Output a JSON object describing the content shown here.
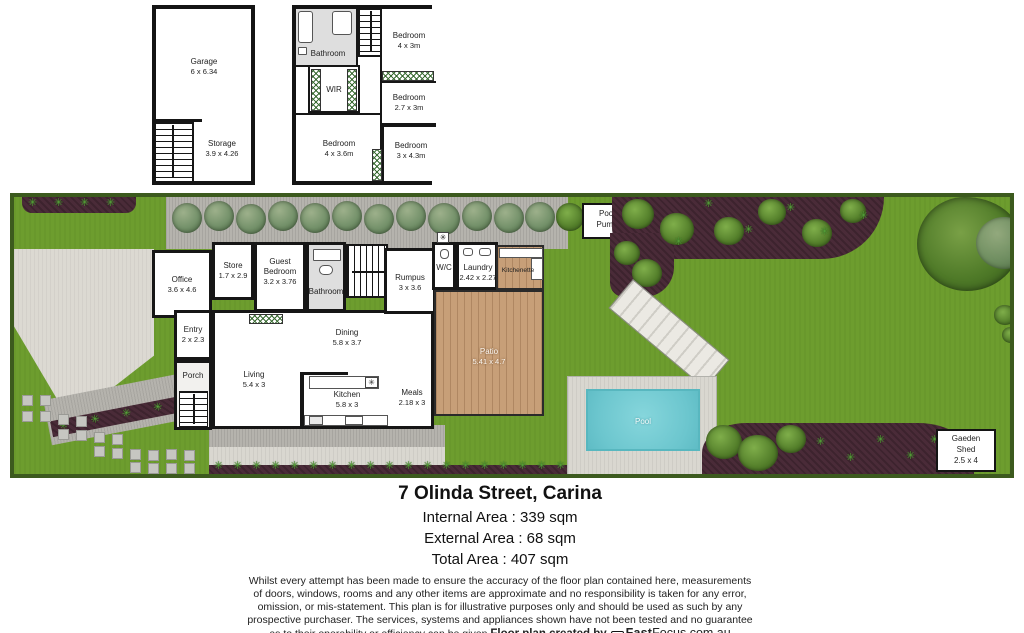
{
  "icons": {
    "plant": "✳",
    "fan": "✳",
    "logo_glyph": "ϟ"
  },
  "garage_plan": {
    "garage": {
      "name": "Garage",
      "dims": "6 x 6.34"
    },
    "storage": {
      "name": "Storage",
      "dims": "3.9 x 4.26"
    }
  },
  "upper_plan": {
    "bathroom": {
      "name": "Bathroom"
    },
    "bed1": {
      "name": "Bedroom",
      "dims": "4 x 3m"
    },
    "wir": {
      "name": "WIR"
    },
    "bed2": {
      "name": "Bedroom",
      "dims": "2.7 x 3m"
    },
    "bed3": {
      "name": "Bedroom",
      "dims": "4 x 3.6m"
    },
    "bed4": {
      "name": "Bedroom",
      "dims": "3 x 4.3m"
    }
  },
  "ground_floor": {
    "office": {
      "name": "Office",
      "dims": "3.6 x 4.6"
    },
    "store": {
      "name": "Store",
      "dims": "1.7 x 2.9"
    },
    "guest_bedroom": {
      "name": "Guest Bedroom",
      "dims": "3.2 x 3.76"
    },
    "bathroom": {
      "name": "Bathroom"
    },
    "rumpus": {
      "name": "Rumpus",
      "dims": "3 x 3.6"
    },
    "wc": {
      "name": "W/C"
    },
    "laundry": {
      "name": "Laundry",
      "dims": "2.42 x 2.27"
    },
    "kitchenette": {
      "name": "Kitchenette"
    },
    "entry": {
      "name": "Entry",
      "dims": "2 x 2.3"
    },
    "porch": {
      "name": "Porch"
    },
    "living": {
      "name": "Living",
      "dims": "5.4 x 3"
    },
    "dining": {
      "name": "Dining",
      "dims": "5.8 x 3.7"
    },
    "kitchen": {
      "name": "Kitchen",
      "dims": "5.8 x 3"
    },
    "meals": {
      "name": "Meals",
      "dims": "2.18 x 3"
    },
    "patio": {
      "name": "Patio",
      "dims": "5.41 x 4.7"
    }
  },
  "site": {
    "pool_pump_l1": "Pool",
    "pool_pump_l2": "Pump",
    "pool": "Pool",
    "shed_l1": "Gaeden",
    "shed_l2": "Shed",
    "shed_l3": "2.5 x 4"
  },
  "footer": {
    "title": "7 Olinda Street, Carina",
    "internal": "Internal Area : 339 sqm",
    "external": "External Area : 68 sqm",
    "total": "Total Area : 407 sqm",
    "disclaimer": [
      "Whilst every attempt has been made to ensure the accuracy of the floor plan contained here, measurements",
      "of doors, windows, rooms and any other items are approximate and no responsibility is taken for any error,",
      "omission, or mis-statement. This plan is for illustrative purposes only and should be used as such by any",
      "prospective purchaser. The services, systems and appliances shown have not been tested and no guarantee",
      "as to their operability or efficiency can be given"
    ],
    "credit_bold": "Floor plan created by",
    "brand_bold": "Fast",
    "brand_light": "Focus",
    "brand_suffix": ".com.au"
  },
  "colors": {
    "grass": "#6d9d2e",
    "mulch": "#4a2b38",
    "gravel": "#b5b3ad",
    "driveway": "#dcd9d2",
    "pool_water": "#6cc6ce",
    "pool_surround": "#dcdcd8",
    "patio_wood": "#c79f78",
    "site_border": "#3c5a1e",
    "walls": "#141414"
  }
}
